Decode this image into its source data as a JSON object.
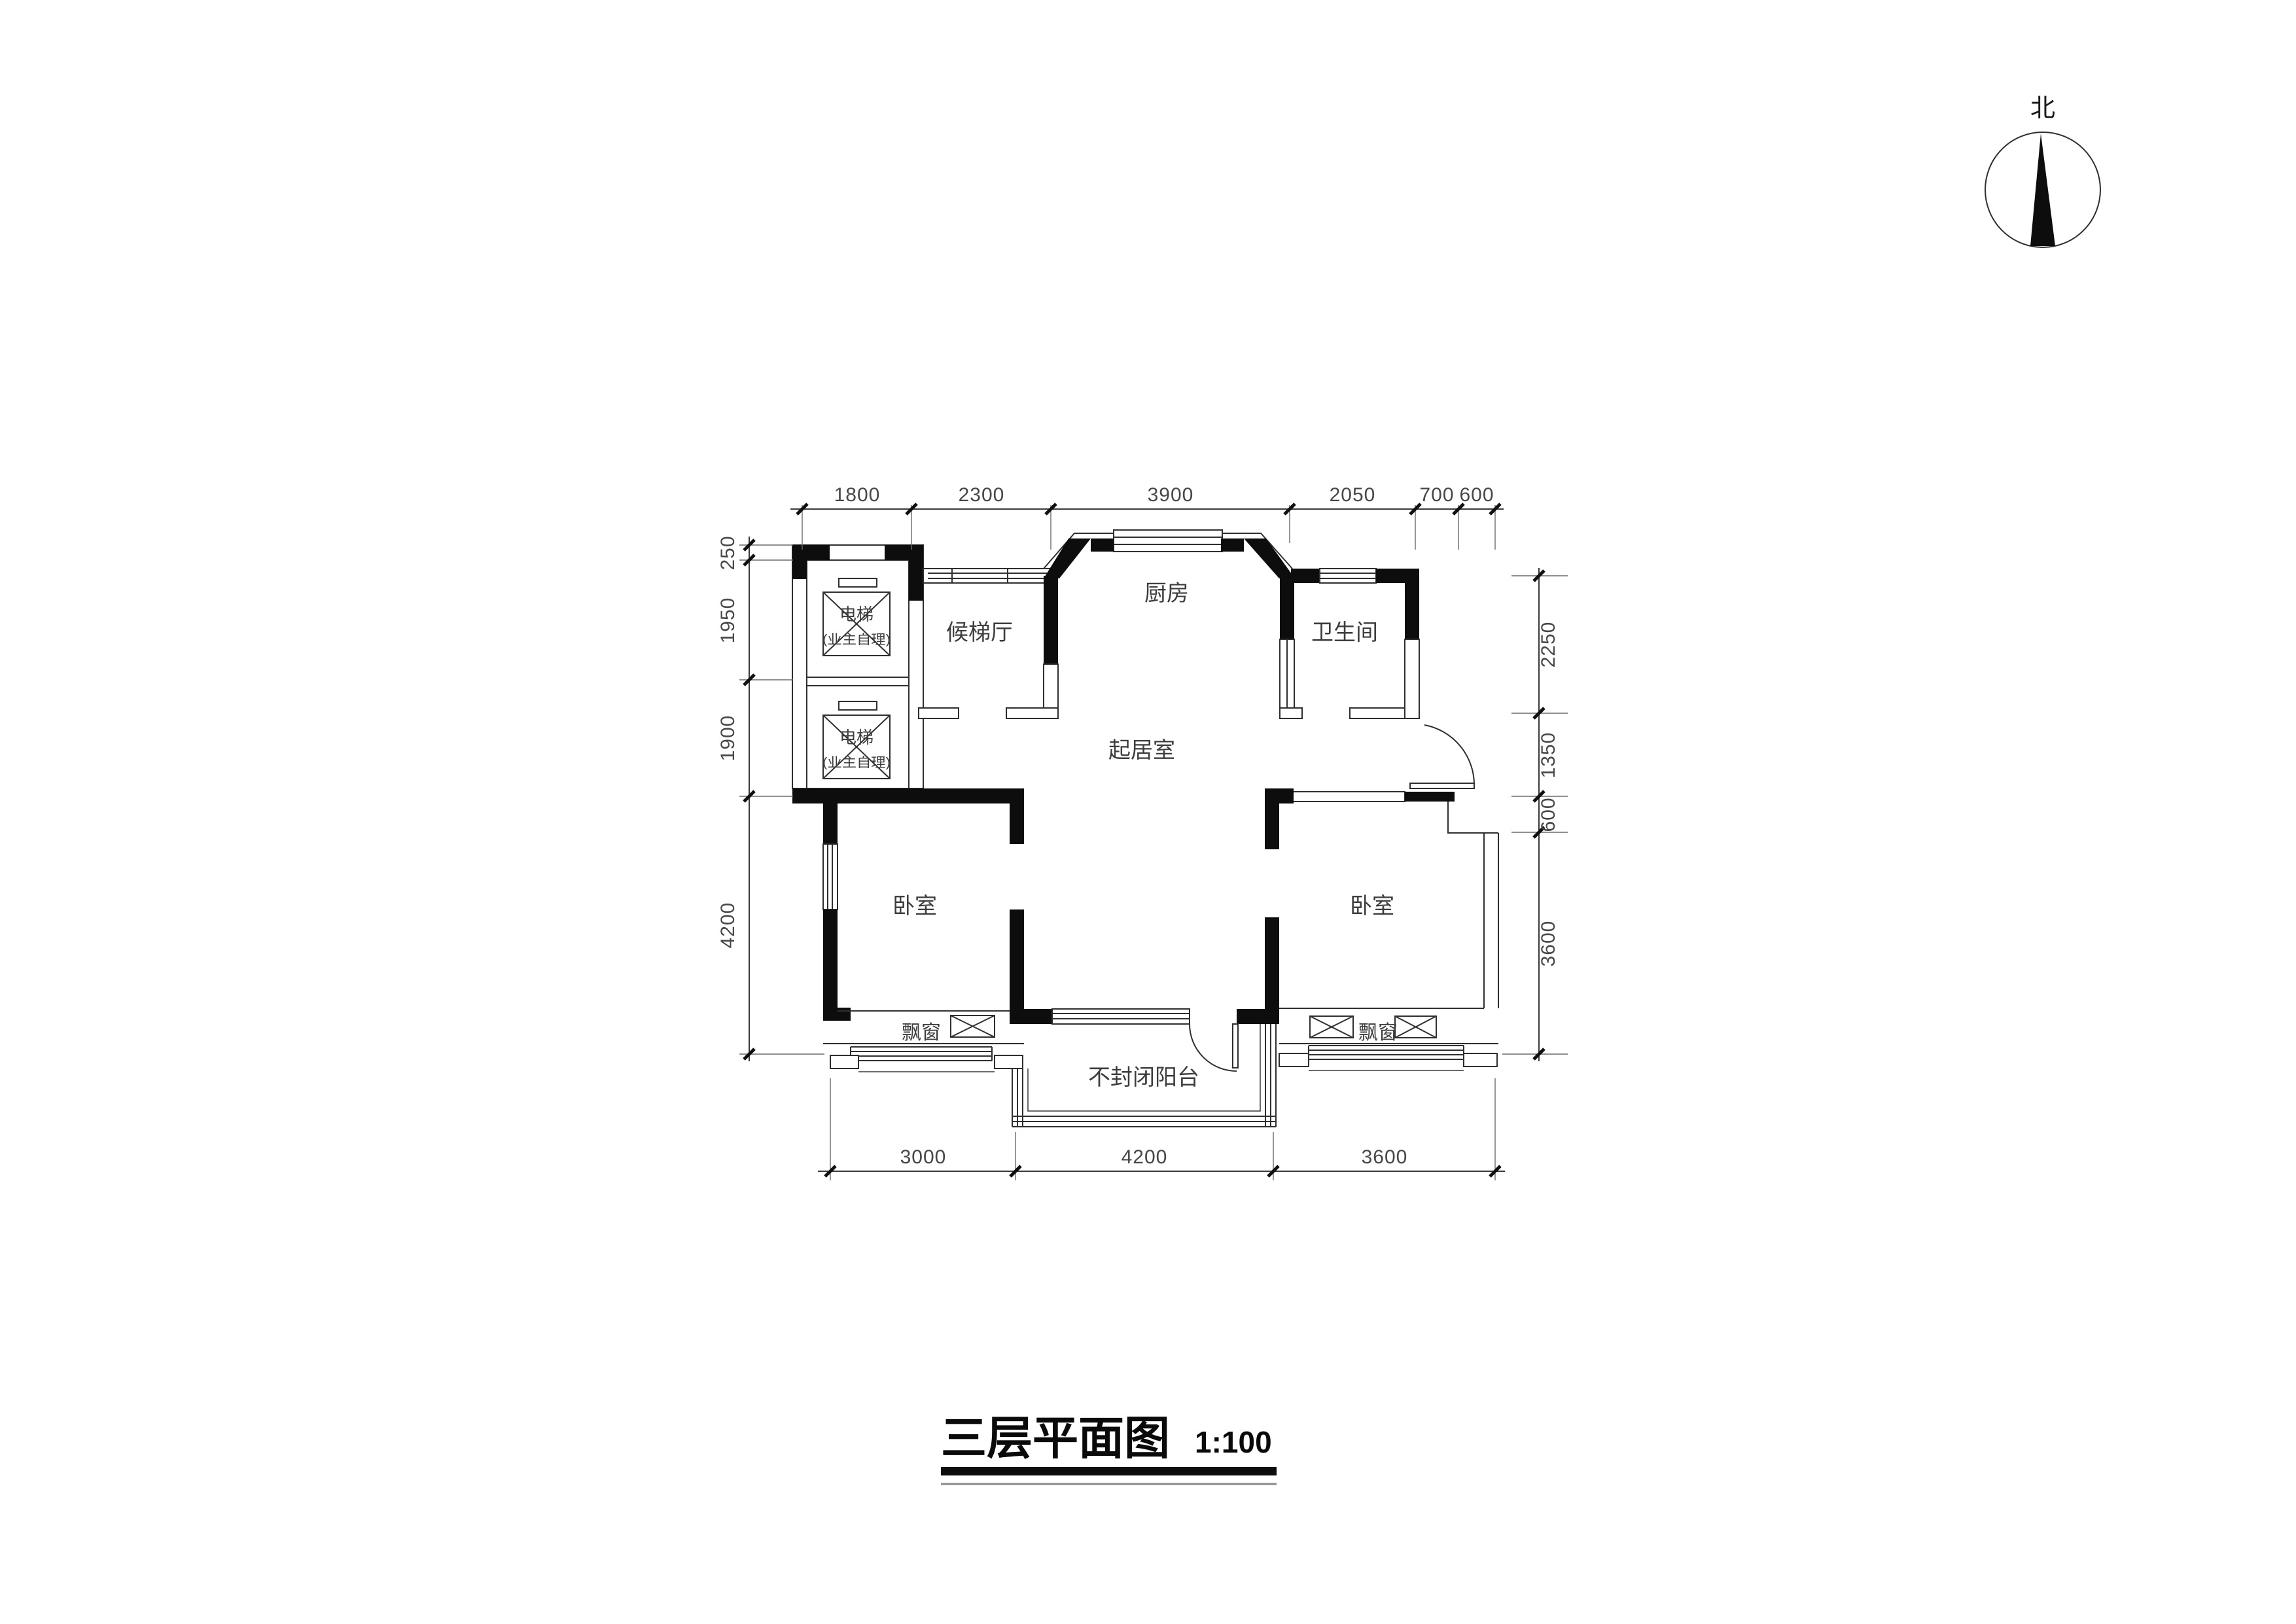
{
  "colors": {
    "background": "#ffffff",
    "wall_fill": "#0d0d0d",
    "line": "#2f2f2f",
    "text": "#3d3d3d"
  },
  "compass": {
    "label": "北"
  },
  "title": {
    "text": "三层平面图",
    "scale": "1:100"
  },
  "rooms": {
    "elevator_top": {
      "name": "电梯",
      "note": "(业主自理)"
    },
    "elevator_bottom": {
      "name": "电梯",
      "note": "(业主自理)"
    },
    "lobby": "候梯厅",
    "kitchen": "厨房",
    "bathroom": "卫生间",
    "living": "起居室",
    "bedroom_left": "卧室",
    "bedroom_right": "卧室",
    "balcony": "不封闭阳台",
    "bay_left": "飘窗",
    "bay_right": "飘窗"
  },
  "dimensions": {
    "top": [
      "1800",
      "2300",
      "3900",
      "2050",
      "700",
      "600"
    ],
    "left": [
      "250",
      "1950",
      "1900",
      "4200"
    ],
    "right": [
      "2250",
      "1350",
      "600",
      "3600"
    ],
    "bottom": [
      "3000",
      "4200",
      "3600"
    ]
  }
}
